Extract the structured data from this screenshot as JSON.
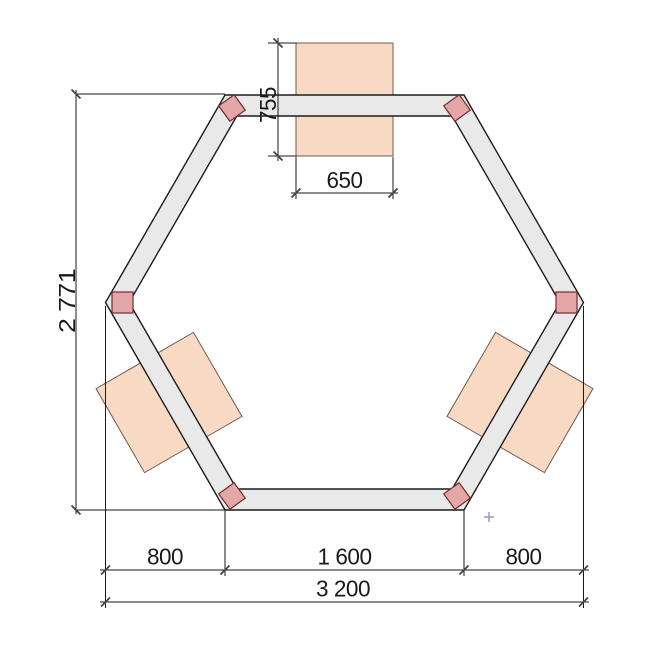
{
  "drawing": {
    "type": "plan-view technical drawing of hexagonal frame with corner posts and three panels",
    "dims": {
      "panel_depth": "755",
      "panel_width": "650",
      "frame_height": "2 771",
      "bottom_segment_left": "800",
      "bottom_segment_middle": "1 600",
      "bottom_segment_right": "800",
      "bottom_total": "3 200"
    }
  },
  "icons": {
    "crosshair_cursor": "+"
  },
  "colors": {
    "background": "#ffffff",
    "beam_fill": "#e9e9e9",
    "beam_stroke": "#1c1c1c",
    "panel_fill": "#f8d9c3",
    "panel_stroke": "#6e5a50",
    "post_fill": "#e4a7a7",
    "post_stroke": "#702e2e",
    "dim_color": "#1a1a1a",
    "tick_color": "#444444",
    "cursor_color": "#9191cb"
  }
}
